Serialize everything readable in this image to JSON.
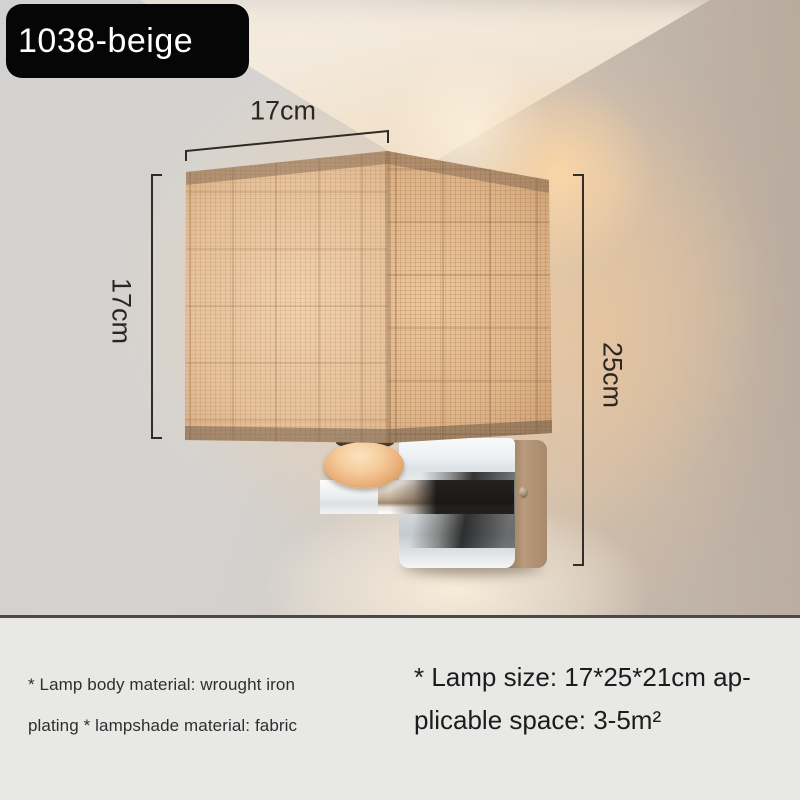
{
  "badge": {
    "label": "1038-beige"
  },
  "dimensions": {
    "width": "17cm",
    "height": "17cm",
    "total_height": "25cm"
  },
  "specs": {
    "material_line1": "* Lamp body material: wrought iron",
    "material_line2": "plating * lampshade material: fabric",
    "size_line1": "* Lamp size: 17*25*21cm ap-",
    "size_line2": "plicable space: 3-5m²"
  },
  "colors": {
    "badge_bg": "#060606",
    "badge_text": "#ffffff",
    "annotation_line": "#2e2a25",
    "panel_bg": "#e8e8e6",
    "separator": "#4e4842",
    "shade_beige": "#e2bd93",
    "chrome": "#dfe3e6",
    "bead": "#eeb988",
    "wall_gray": "#d3d2d0",
    "glow_warm": "#f3d3a8"
  }
}
